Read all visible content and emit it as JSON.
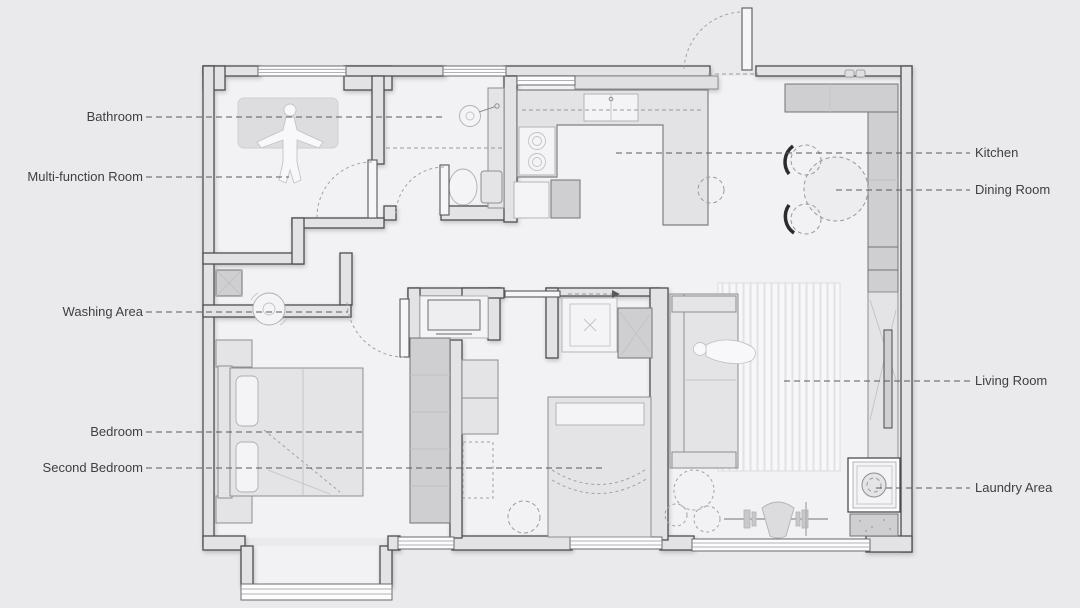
{
  "title": "Apartment Floor Plan",
  "colors": {
    "bg": "#eaeaec",
    "floor": "#f2f2f4",
    "wall-fill": "#e3e3e5",
    "wall-line": "#4d4d50",
    "furn-line": "#8e8e92",
    "furn-fill": "#e4e4e7",
    "cabinet": "#cfcfd2",
    "text": "#3f3f41",
    "leader": "#5a5a5d"
  },
  "labels": {
    "left": [
      {
        "id": "bathroom",
        "text": "Bathroom"
      },
      {
        "id": "multi-function-room",
        "text": "Multi-function Room"
      },
      {
        "id": "washing-area",
        "text": "Washing Area"
      },
      {
        "id": "bedroom",
        "text": "Bedroom"
      },
      {
        "id": "second-bedroom",
        "text": "Second Bedroom"
      }
    ],
    "right": [
      {
        "id": "kitchen",
        "text": "Kitchen"
      },
      {
        "id": "dining-room",
        "text": "Dining Room"
      },
      {
        "id": "living-room",
        "text": "Living Room"
      },
      {
        "id": "laundry-area",
        "text": "Laundry Area"
      }
    ]
  }
}
